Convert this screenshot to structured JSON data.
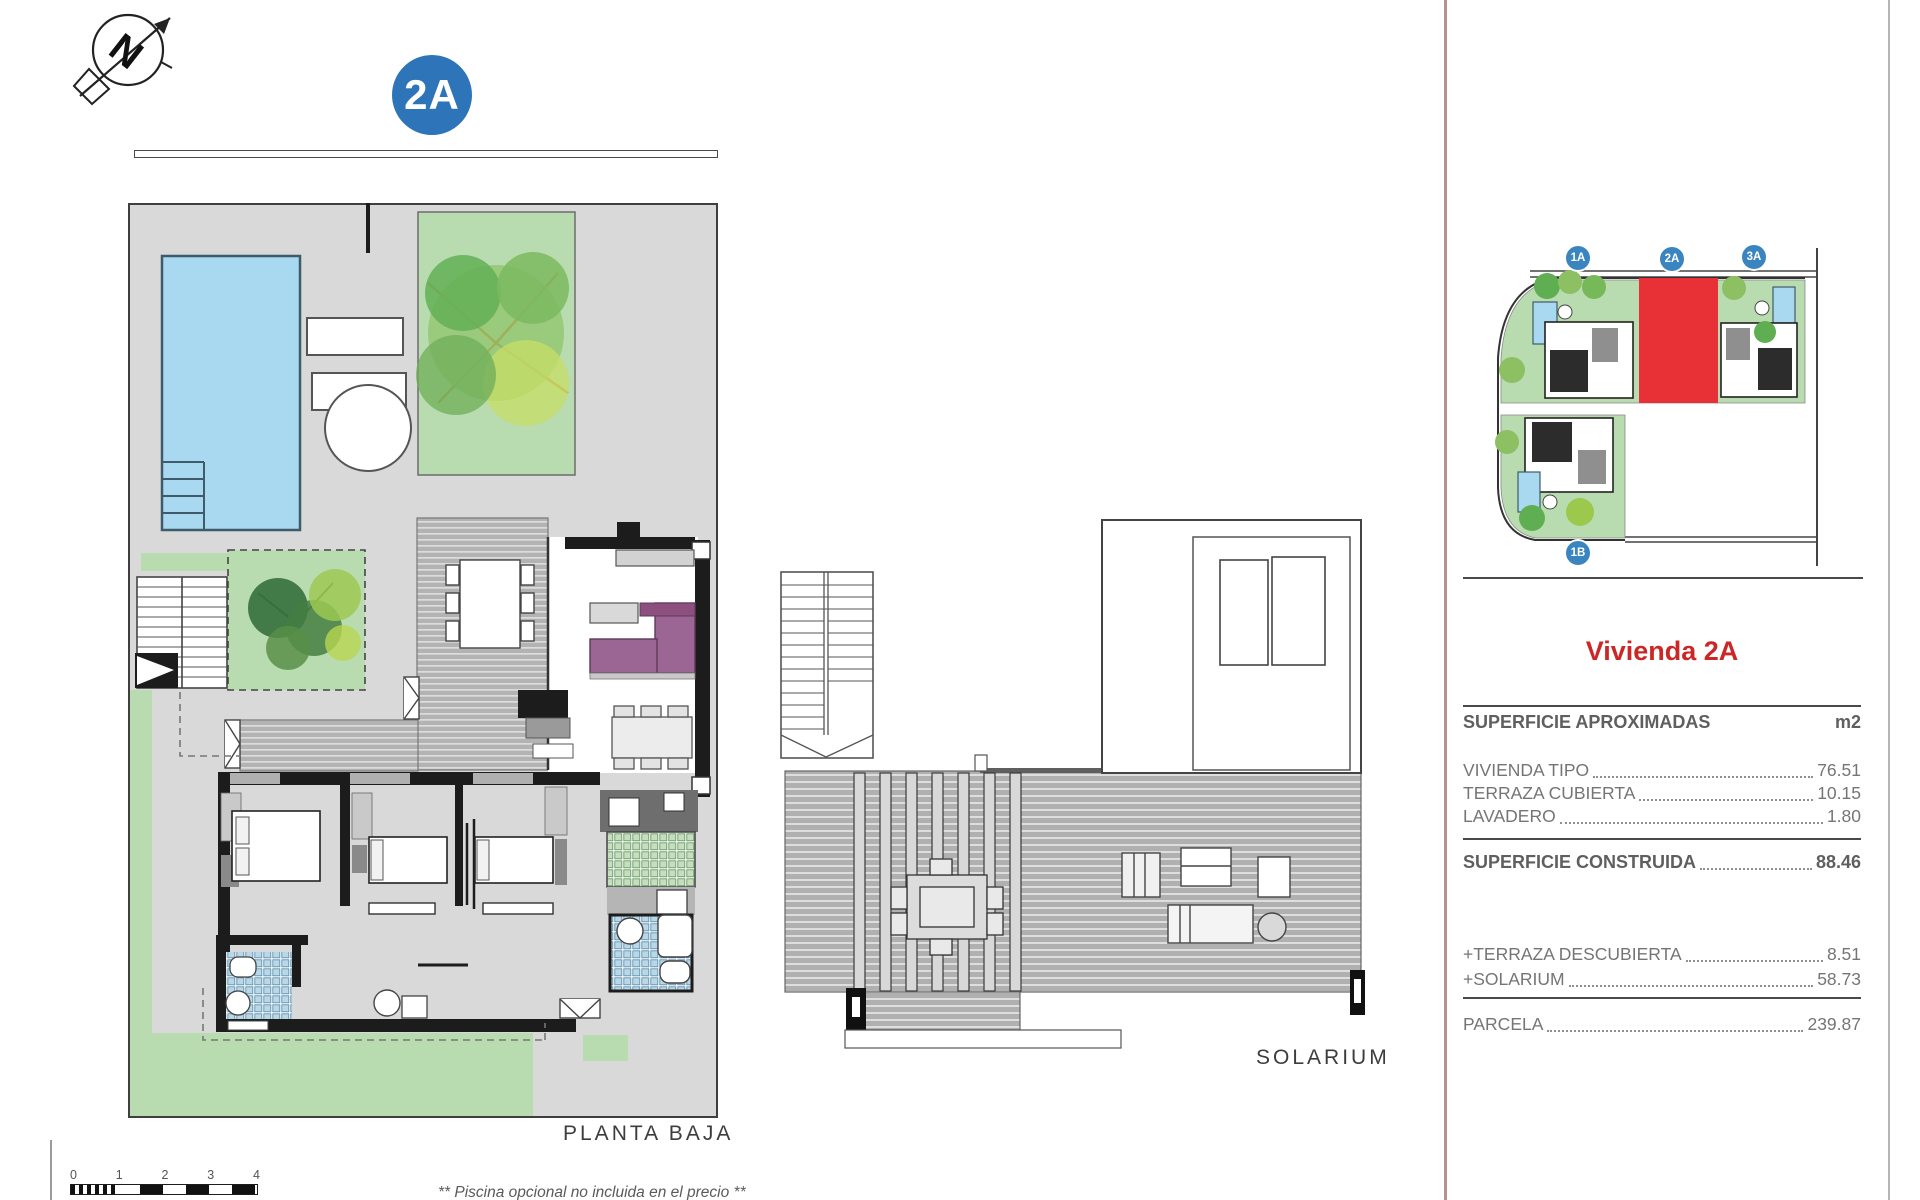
{
  "header": {
    "unit_badge": "2A"
  },
  "plan_labels": {
    "ground_floor": "PLANTA BAJA",
    "solarium": "SOLARIUM"
  },
  "site_plan": {
    "units": [
      {
        "id": "1A"
      },
      {
        "id": "2A"
      },
      {
        "id": "3A"
      },
      {
        "id": "1B"
      }
    ],
    "highlight_color": "#e73137",
    "badge_color": "#3a85c0"
  },
  "sidebar": {
    "title": "Vivienda 2A",
    "title_color": "#cb2727",
    "table": {
      "header": {
        "label": "SUPERFICIE APROXIMADAS",
        "unit": "m2"
      },
      "rows": [
        {
          "label": "VIVIENDA TIPO",
          "value": "76.51"
        },
        {
          "label": "TERRAZA CUBIERTA",
          "value": "10.15"
        },
        {
          "label": "LAVADERO",
          "value": "1.80"
        }
      ],
      "total": {
        "label": "SUPERFICIE CONSTRUIDA",
        "value": "88.46"
      },
      "extras": [
        {
          "label": "+TERRAZA DESCUBIERTA",
          "value": "8.51"
        },
        {
          "label": "+SOLARIUM",
          "value": "58.73"
        }
      ],
      "parcel": {
        "label": "PARCELA",
        "value": "239.87"
      }
    }
  },
  "scale_bar": {
    "ticks": [
      "0",
      "1",
      "2",
      "3",
      "4"
    ]
  },
  "disclaimer": "** Piscina opcional no incluida en el precio **",
  "colors": {
    "accent_red_line": "#b98f93",
    "badge_blue": "#2e74b8",
    "pool_blue": "#a9d9f0",
    "grass_green": "#b8dcb0",
    "plot_grey": "#d9d9d9",
    "sofa_purple": "#9c6694"
  }
}
